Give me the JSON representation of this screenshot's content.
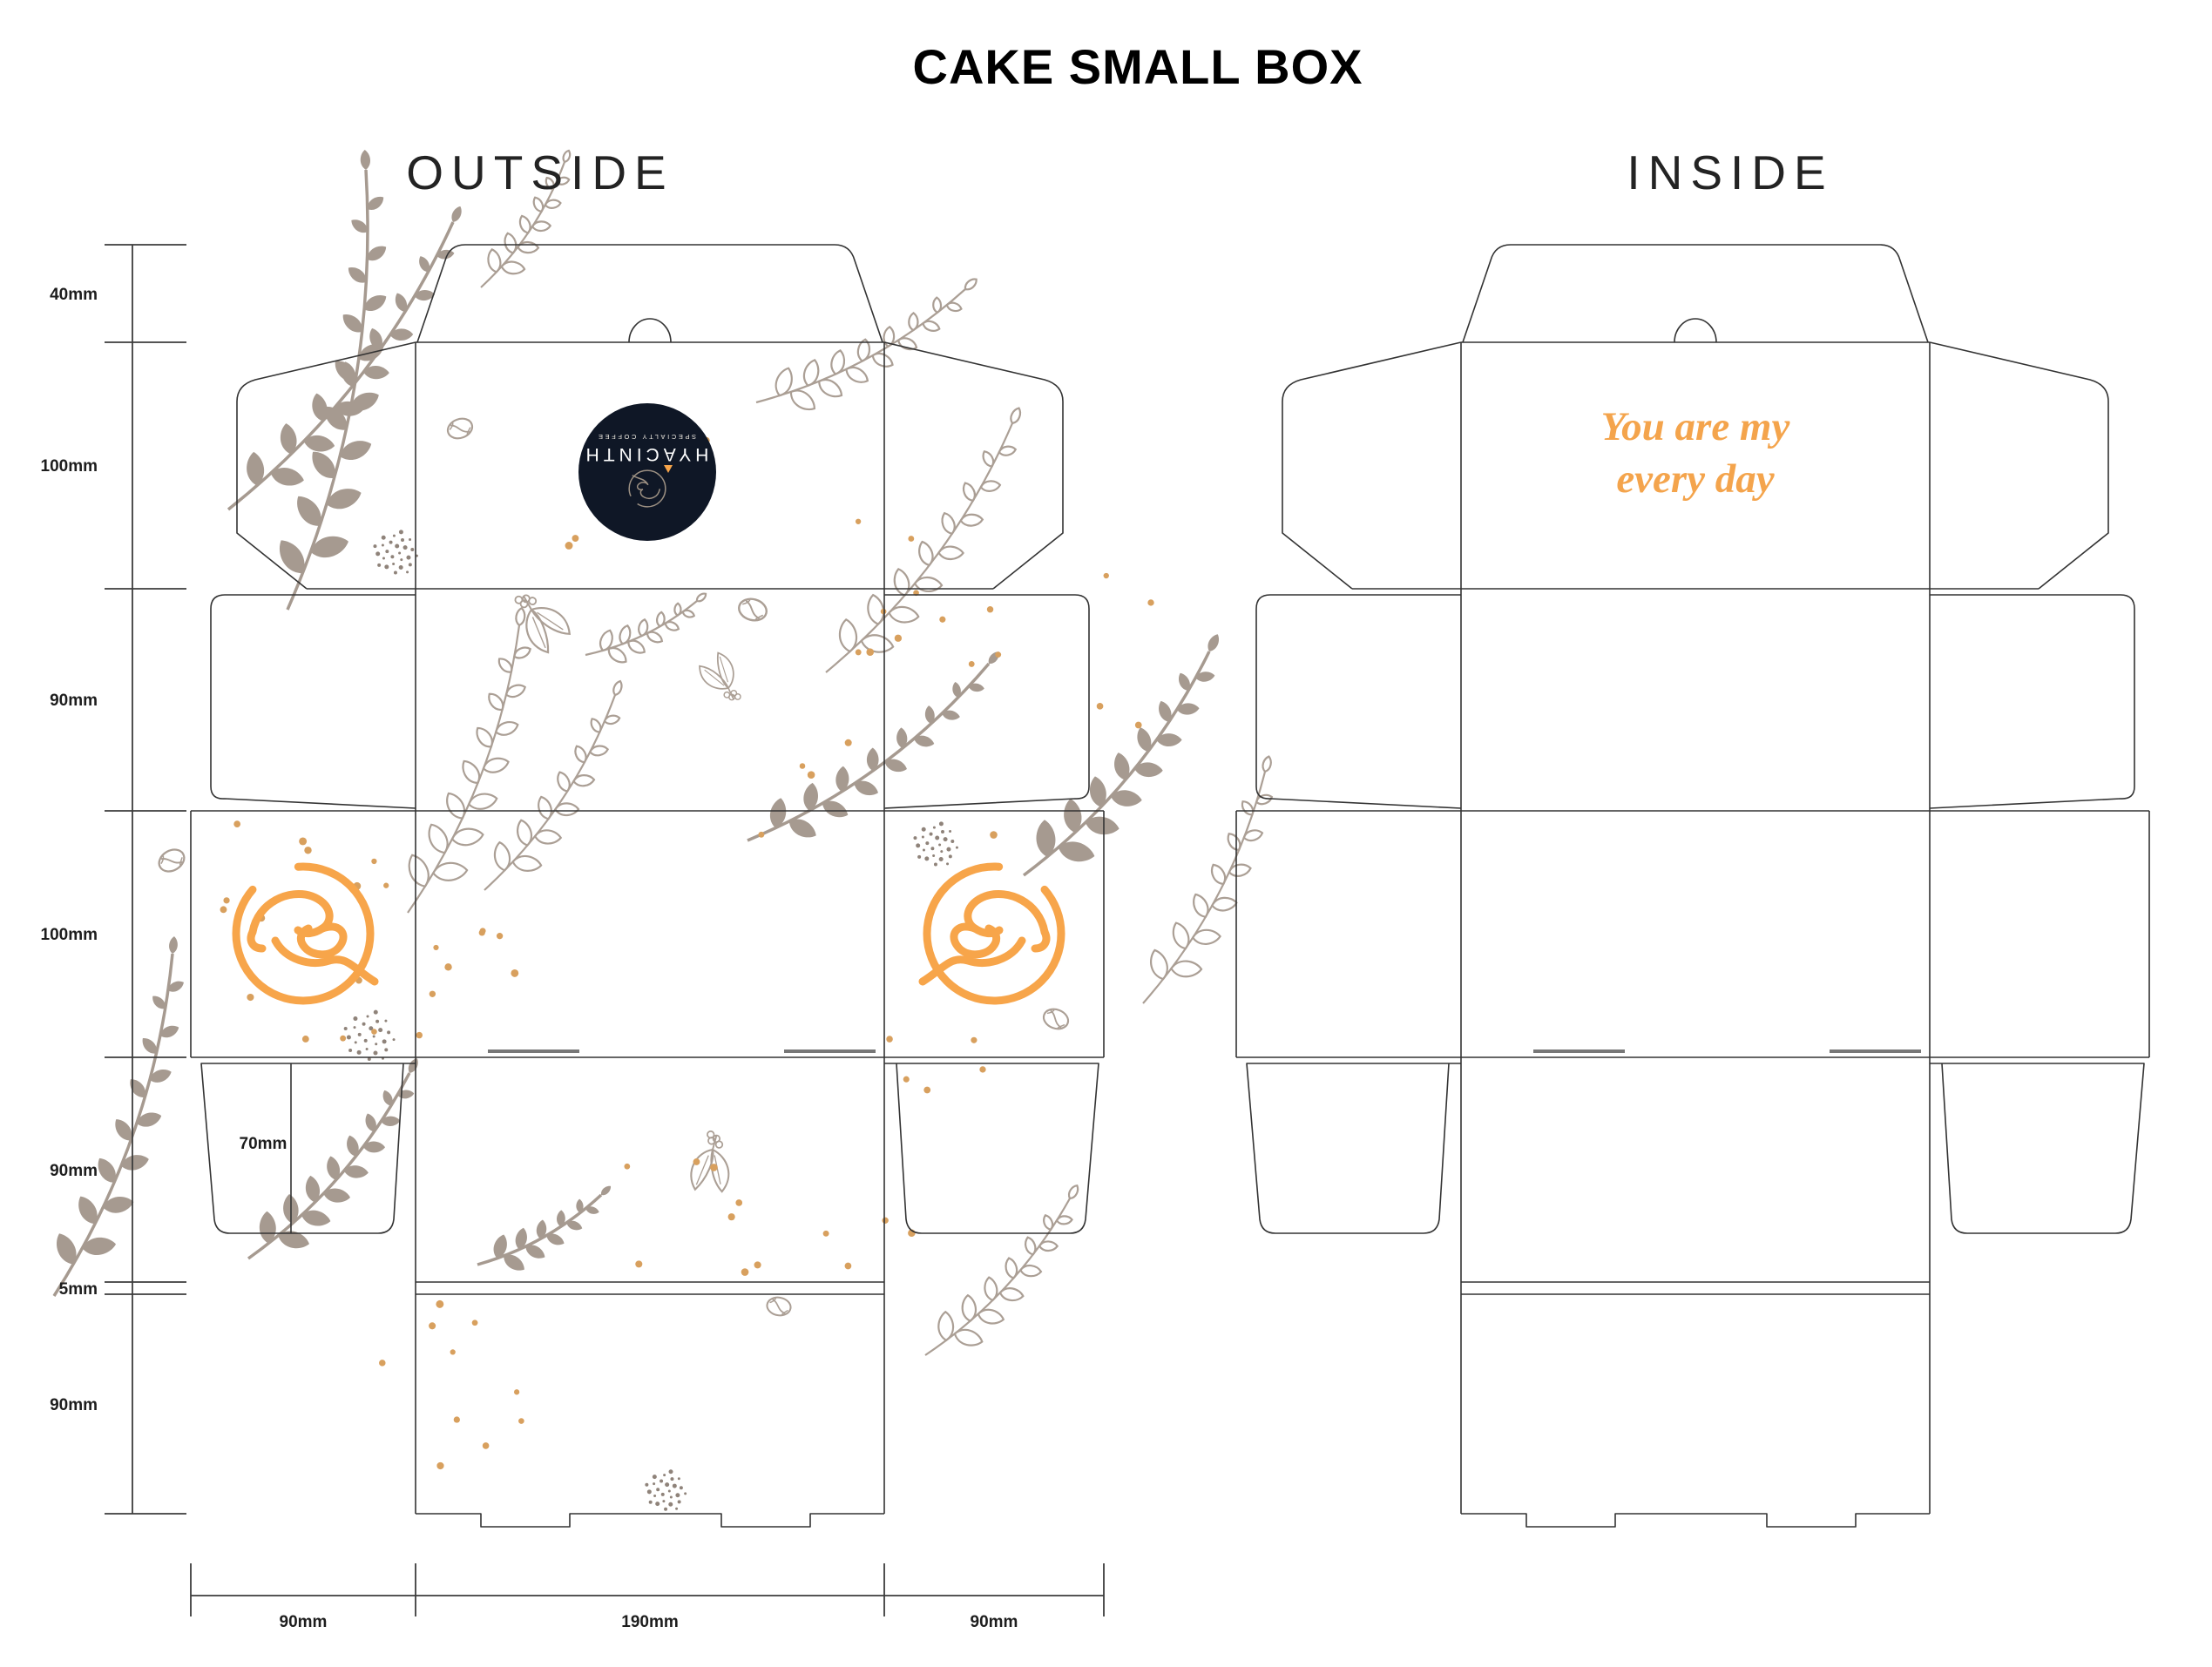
{
  "title": "CAKE SMALL BOX",
  "views": {
    "outside": "OUTSIDE",
    "inside": "INSIDE"
  },
  "quote": {
    "line1": "You are my",
    "line2": "every day"
  },
  "brand": {
    "name": "HYACINTH",
    "tagline": "SPECIALTY COFFEE"
  },
  "measurements": {
    "left_ruler": [
      "40mm",
      "100mm",
      "90mm",
      "100mm",
      "90mm",
      "5mm",
      "90mm"
    ],
    "bottom_ruler": [
      "90mm",
      "190mm",
      "90mm"
    ],
    "inner_flap": "70mm"
  },
  "colors": {
    "leaf_solid": "#a69a90",
    "leaf_outline": "#ab9f95",
    "accent_orange": "#f7a54a",
    "dot_orange": "#d8a05e",
    "badge_navy": "#0f1726",
    "dieline": "#333333",
    "ruler": "#3c3c3c",
    "quote_orange": "#f4a44c",
    "stipple": "#8f837a",
    "slit_gray": "#777777",
    "text_dark": "#1d1d1d"
  }
}
